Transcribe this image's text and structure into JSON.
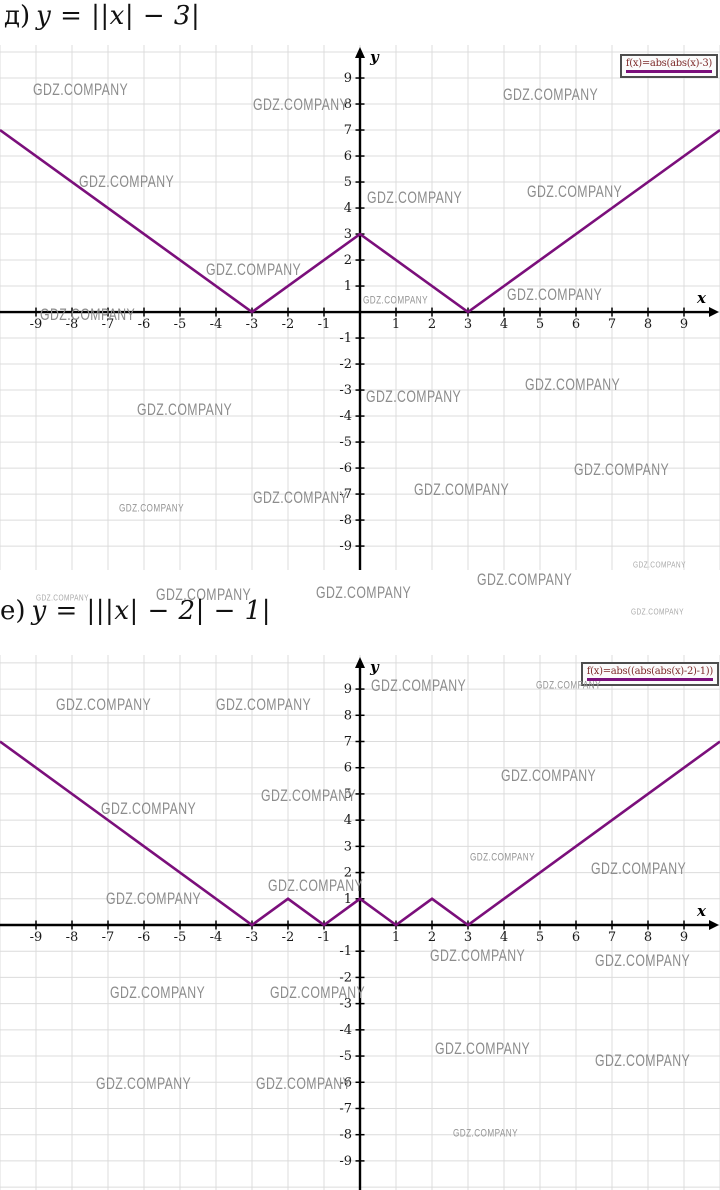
{
  "watermark": {
    "text": "GDZ.COMPANY",
    "color": "#8c8c8c"
  },
  "titles": [
    {
      "label": "д)",
      "formula": "y = ||x| − 3|"
    },
    {
      "label": "е)",
      "formula": "y = |||x| − 2| − 1|"
    }
  ],
  "chart_data": [
    {
      "type": "line",
      "title": "д) y = ||x| − 3|",
      "legend": "f(x)=abs(abs(x)-3)",
      "xlabel": "x",
      "ylabel": "y",
      "xlim": [
        -10,
        10
      ],
      "ylim": [
        -9.92,
        10.27
      ],
      "x_ticks": [
        -9,
        -8,
        -7,
        -6,
        -5,
        -4,
        -3,
        -2,
        -1,
        1,
        2,
        3,
        4,
        5,
        6,
        7,
        8,
        9
      ],
      "y_ticks": [
        -9,
        -8,
        -7,
        -6,
        -5,
        -4,
        -3,
        -2,
        -1,
        1,
        2,
        3,
        4,
        5,
        6,
        7,
        8,
        9
      ],
      "grid": true,
      "legend_position": "top-right",
      "line_color": "#7b0f7b",
      "points": [
        [
          -10,
          7
        ],
        [
          -3,
          0
        ],
        [
          0,
          3
        ],
        [
          3,
          0
        ],
        [
          10,
          7
        ]
      ]
    },
    {
      "type": "line",
      "title": "е) y = |||x| − 2| − 1|",
      "legend": "f(x)=abs((abs(abs(x)-2)-1))",
      "xlabel": "x",
      "ylabel": "y",
      "xlim": [
        -10,
        10
      ],
      "ylim": [
        -10.11,
        10.3
      ],
      "x_ticks": [
        -9,
        -8,
        -7,
        -6,
        -5,
        -4,
        -3,
        -2,
        -1,
        1,
        2,
        3,
        4,
        5,
        6,
        7,
        8,
        9
      ],
      "y_ticks": [
        -9,
        -8,
        -7,
        -6,
        -5,
        -4,
        -3,
        -2,
        -1,
        1,
        2,
        3,
        4,
        5,
        6,
        7,
        8,
        9
      ],
      "grid": true,
      "legend_position": "top-right",
      "line_color": "#7b0f7b",
      "points": [
        [
          -10,
          7
        ],
        [
          -3,
          0
        ],
        [
          -2,
          1
        ],
        [
          -1,
          0
        ],
        [
          0,
          1
        ],
        [
          1,
          0
        ],
        [
          2,
          1
        ],
        [
          3,
          0
        ],
        [
          10,
          7
        ]
      ]
    }
  ],
  "watermarks": [
    {
      "x": 33,
      "y": 81,
      "s": "n"
    },
    {
      "x": 253,
      "y": 96,
      "s": "n"
    },
    {
      "x": 503,
      "y": 86,
      "s": "n"
    },
    {
      "x": 79,
      "y": 173,
      "s": "n"
    },
    {
      "x": 367,
      "y": 189,
      "s": "n"
    },
    {
      "x": 527,
      "y": 183,
      "s": "n"
    },
    {
      "x": 206,
      "y": 261,
      "s": "n"
    },
    {
      "x": 507,
      "y": 286,
      "s": "n"
    },
    {
      "x": 40,
      "y": 306,
      "s": "n"
    },
    {
      "x": 363,
      "y": 295,
      "s": "s"
    },
    {
      "x": 366,
      "y": 388,
      "s": "n"
    },
    {
      "x": 525,
      "y": 376,
      "s": "n"
    },
    {
      "x": 137,
      "y": 401,
      "s": "n"
    },
    {
      "x": 574,
      "y": 461,
      "s": "n"
    },
    {
      "x": 414,
      "y": 481,
      "s": "n"
    },
    {
      "x": 253,
      "y": 489,
      "s": "n"
    },
    {
      "x": 119,
      "y": 503,
      "s": "s"
    },
    {
      "x": 316,
      "y": 584,
      "s": "n"
    },
    {
      "x": 477,
      "y": 571,
      "s": "n"
    },
    {
      "x": 633,
      "y": 560,
      "s": "t"
    },
    {
      "x": 36,
      "y": 593,
      "s": "t"
    },
    {
      "x": 156,
      "y": 586,
      "s": "n"
    },
    {
      "x": 631,
      "y": 607,
      "s": "t"
    },
    {
      "x": 371,
      "y": 677,
      "s": "n"
    },
    {
      "x": 56,
      "y": 696,
      "s": "n"
    },
    {
      "x": 216,
      "y": 696,
      "s": "n"
    },
    {
      "x": 536,
      "y": 680,
      "s": "s"
    },
    {
      "x": 501,
      "y": 767,
      "s": "n"
    },
    {
      "x": 101,
      "y": 800,
      "s": "n"
    },
    {
      "x": 261,
      "y": 787,
      "s": "n"
    },
    {
      "x": 591,
      "y": 860,
      "s": "n"
    },
    {
      "x": 470,
      "y": 852,
      "s": "s"
    },
    {
      "x": 106,
      "y": 890,
      "s": "n"
    },
    {
      "x": 268,
      "y": 877,
      "s": "n"
    },
    {
      "x": 430,
      "y": 947,
      "s": "n"
    },
    {
      "x": 595,
      "y": 952,
      "s": "n"
    },
    {
      "x": 110,
      "y": 984,
      "s": "n"
    },
    {
      "x": 270,
      "y": 984,
      "s": "n"
    },
    {
      "x": 435,
      "y": 1040,
      "s": "n"
    },
    {
      "x": 595,
      "y": 1052,
      "s": "n"
    },
    {
      "x": 96,
      "y": 1075,
      "s": "n"
    },
    {
      "x": 256,
      "y": 1075,
      "s": "n"
    },
    {
      "x": 453,
      "y": 1128,
      "s": "s"
    }
  ]
}
